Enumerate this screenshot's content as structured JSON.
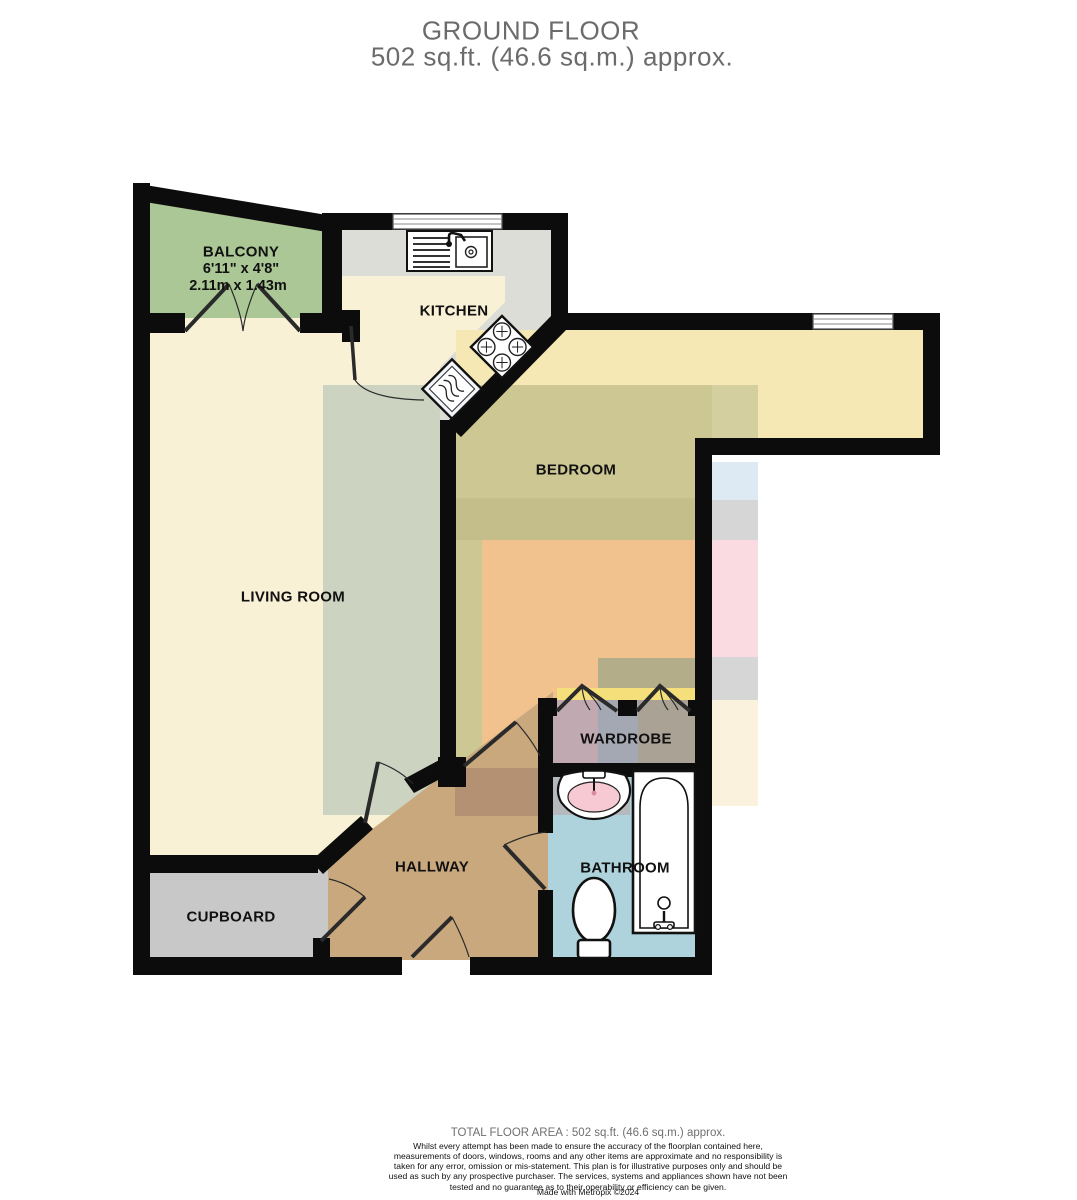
{
  "title": {
    "line1": "GROUND FLOOR",
    "line2": "502 sq.ft. (46.6 sq.m.) approx."
  },
  "rooms": {
    "balcony": {
      "label": "BALCONY",
      "dims_imperial": "6'11\" x 4'8\"",
      "dims_metric": "2.11m x 1.43m"
    },
    "kitchen": {
      "label": "KITCHEN"
    },
    "bedroom": {
      "label": "BEDROOM"
    },
    "living_room": {
      "label": "LIVING ROOM"
    },
    "wardrobe": {
      "label": "WARDROBE"
    },
    "hallway": {
      "label": "HALLWAY"
    },
    "bathroom": {
      "label": "BATHROOM"
    },
    "cupboard": {
      "label": "CUPBOARD"
    }
  },
  "footer": {
    "total_area": "TOTAL FLOOR AREA : 502 sq.ft. (46.6 sq.m.) approx.",
    "disclaimer": "Whilst every attempt has been made to ensure the accuracy of the floorplan contained here, measurements of doors, windows, rooms and any other items are approximate and no responsibility is taken for any error, omission or mis-statement. This plan is for illustrative purposes only and should be used as such by any prospective purchaser. The services, systems and appliances shown have not been tested and no guarantee as to their operability or efficiency can be given.",
    "credit": "Made with Metropix ©2024"
  },
  "colors": {
    "wall": "#0c0c0c",
    "balcony_green": "#aac795",
    "floor_cream": "#f8f1d6",
    "counter_gray": "#dcddd6",
    "bedroom_yellow": "#f6e8b4",
    "olive_overlay": "#cdc893",
    "rug_green": "#ccd3c1",
    "bed_orange": "#f1c28d",
    "hallway_tan": "#c9a87e",
    "cupboard_gray": "#c8c8c8",
    "wardrobe_mauve": "#c1a9b1",
    "bathroom_blue": "#aed3dc",
    "sink_pink": "#f7c9d3",
    "strip_pink": "#fadbe2",
    "strip_blue": "#dde9f3",
    "title_gray": "#6b6b6b"
  }
}
